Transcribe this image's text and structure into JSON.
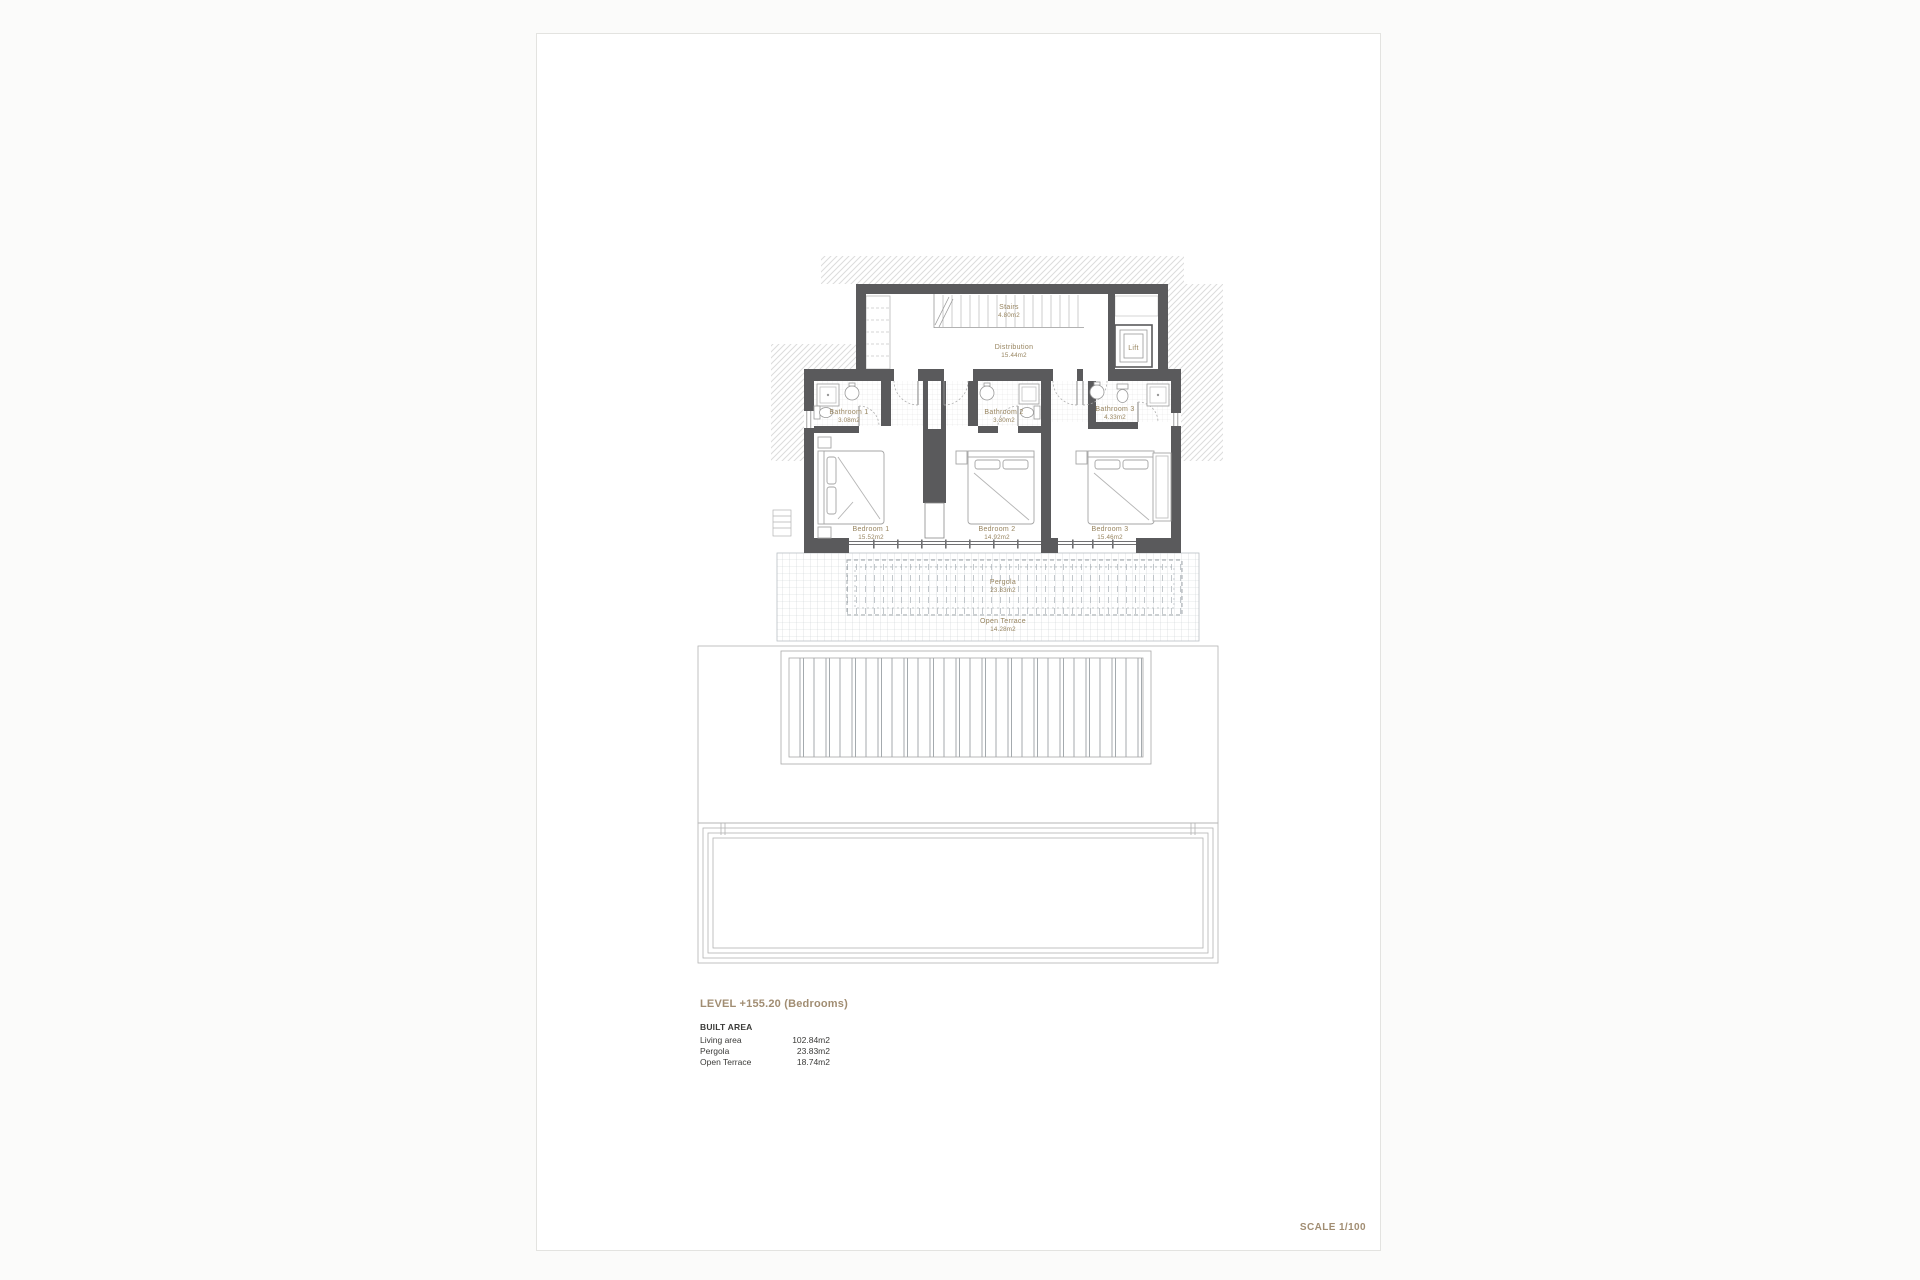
{
  "titleblock": {
    "level_title": "LEVEL +155.20 (Bedrooms)",
    "built_area_heading": "BUILT AREA",
    "areas": [
      {
        "label": "Living area",
        "value": "102.84m2"
      },
      {
        "label": "Pergola",
        "value": "23.83m2"
      },
      {
        "label": "Open Terrace",
        "value": "18.74m2"
      }
    ],
    "scale_label": "SCALE 1/100"
  },
  "plan": {
    "rooms": {
      "stairs": {
        "name": "Stairs",
        "area": "4.80m2"
      },
      "distribution": {
        "name": "Distribution",
        "area": "15.44m2"
      },
      "lift": {
        "name": "Lift"
      },
      "bathroom1": {
        "name": "Bathroom 1",
        "area": "3.08m2"
      },
      "bathroom2": {
        "name": "Bathroom 2",
        "area": "3.30m2"
      },
      "bathroom3": {
        "name": "Bathroom 3",
        "area": "4.33m2"
      },
      "bedroom1": {
        "name": "Bedroom 1",
        "area": "15.52m2"
      },
      "bedroom2": {
        "name": "Bedroom 2",
        "area": "14.92m2"
      },
      "bedroom3": {
        "name": "Bedroom 3",
        "area": "15.46m2"
      },
      "pergola": {
        "name": "Pergola",
        "area": "23.83m2"
      },
      "open_terrace": {
        "name": "Open Terrace",
        "area": "14.28m2"
      }
    },
    "colors": {
      "wall": "#5a5a5c",
      "room_label": "#97845f",
      "accent_text": "#a18d72",
      "hatch": "#dcdcdc",
      "terrace_grid": "#ccd1d6"
    }
  }
}
